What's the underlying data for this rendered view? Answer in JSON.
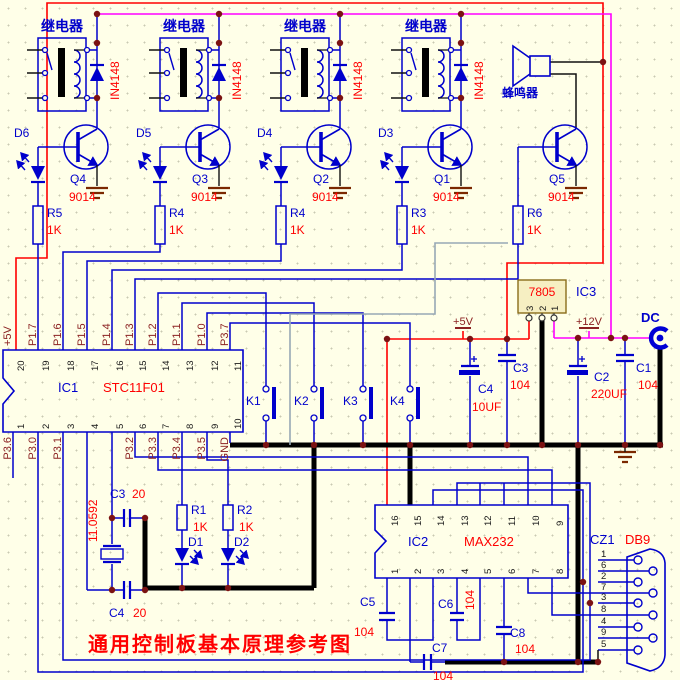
{
  "colors": {
    "background": "#FFFFE8",
    "wire_blue": "#0000CC",
    "value_red": "#FF0000",
    "label_maroon": "#8B2121",
    "power_red": "#FF0000",
    "power_magenta": "#FF00FF",
    "ground_black": "#000000",
    "junction_dark_red": "#7B1212",
    "gray_wire": "#97A8B5",
    "ic_fill": "#F6EFC2"
  },
  "title": "通用控制板基本原理参考图",
  "relays": {
    "label": "继电器",
    "diode": "IN4148"
  },
  "buzzer": {
    "label": "蜂鸣器"
  },
  "drivers": {
    "transistors": [
      {
        "ref": "Q4",
        "part": "9014"
      },
      {
        "ref": "Q3",
        "part": "9014"
      },
      {
        "ref": "Q2",
        "part": "9014"
      },
      {
        "ref": "Q1",
        "part": "9014"
      },
      {
        "ref": "Q5",
        "part": "9014"
      }
    ],
    "leds": [
      "D6",
      "D5",
      "D4",
      "D3"
    ],
    "resistors": [
      {
        "ref": "R5",
        "value": "1K"
      },
      {
        "ref": "R4",
        "value": "1K"
      },
      {
        "ref": "R4",
        "value": "1K"
      },
      {
        "ref": "R3",
        "value": "1K"
      },
      {
        "ref": "R6",
        "value": "1K"
      }
    ]
  },
  "ic1": {
    "ref": "IC1",
    "part": "STC11F01",
    "top_pins": [
      {
        "num": "20",
        "label": "+5V"
      },
      {
        "num": "19",
        "label": "P1.7"
      },
      {
        "num": "18",
        "label": "P1.6"
      },
      {
        "num": "17",
        "label": "P1.5"
      },
      {
        "num": "16",
        "label": "P1.4"
      },
      {
        "num": "15",
        "label": "P1.3"
      },
      {
        "num": "14",
        "label": "P1.2"
      },
      {
        "num": "13",
        "label": "P1.1"
      },
      {
        "num": "12",
        "label": "P1.0"
      },
      {
        "num": "11",
        "label": "P3.7"
      }
    ],
    "bottom_pins": [
      {
        "num": "1",
        "label": "P3.6"
      },
      {
        "num": "2",
        "label": "P3.0"
      },
      {
        "num": "3",
        "label": "P3.1"
      },
      {
        "num": "4",
        "label": ""
      },
      {
        "num": "5",
        "label": ""
      },
      {
        "num": "6",
        "label": "P3.2"
      },
      {
        "num": "7",
        "label": "P3.3"
      },
      {
        "num": "8",
        "label": "P3.4"
      },
      {
        "num": "9",
        "label": "P3.5"
      },
      {
        "num": "10",
        "label": "GND"
      }
    ]
  },
  "buttons": [
    "K1",
    "K2",
    "K3",
    "K4"
  ],
  "power": {
    "regulator": {
      "ref": "IC3",
      "part": "7805",
      "pins": [
        "3",
        "2",
        "1"
      ]
    },
    "rails": {
      "v5": "+5V",
      "v12": "+12V",
      "dc": "DC"
    },
    "capacitors": [
      {
        "ref": "C4",
        "value": "10UF"
      },
      {
        "ref": "C3",
        "value": "104"
      },
      {
        "ref": "C2",
        "value": "220UF"
      },
      {
        "ref": "C1",
        "value": "104"
      }
    ]
  },
  "serial": {
    "ic2": {
      "ref": "IC2",
      "part": "MAX232",
      "top_pins": [
        "16",
        "15",
        "14",
        "13",
        "12",
        "11",
        "10",
        "9"
      ],
      "bottom_pins": [
        "1",
        "2",
        "3",
        "4",
        "5",
        "6",
        "7",
        "8"
      ]
    },
    "capacitors": [
      {
        "ref": "C5",
        "value": "104"
      },
      {
        "ref": "C6",
        "value": "104"
      },
      {
        "ref": "C7",
        "value": "104"
      },
      {
        "ref": "C8",
        "value": "104"
      }
    ],
    "connector": {
      "ref": "CZ1",
      "part": "DB9",
      "pins": [
        "1",
        "6",
        "2",
        "7",
        "3",
        "8",
        "4",
        "9",
        "5"
      ]
    }
  },
  "oscillator": {
    "crystal": "11.0592",
    "caps": [
      {
        "ref": "C3",
        "value": "20"
      },
      {
        "ref": "C4",
        "value": "20"
      }
    ]
  },
  "indicators": {
    "resistors": [
      {
        "ref": "R1",
        "value": "1K"
      },
      {
        "ref": "R2",
        "value": "1K"
      }
    ],
    "leds": [
      "D1",
      "D2"
    ]
  }
}
